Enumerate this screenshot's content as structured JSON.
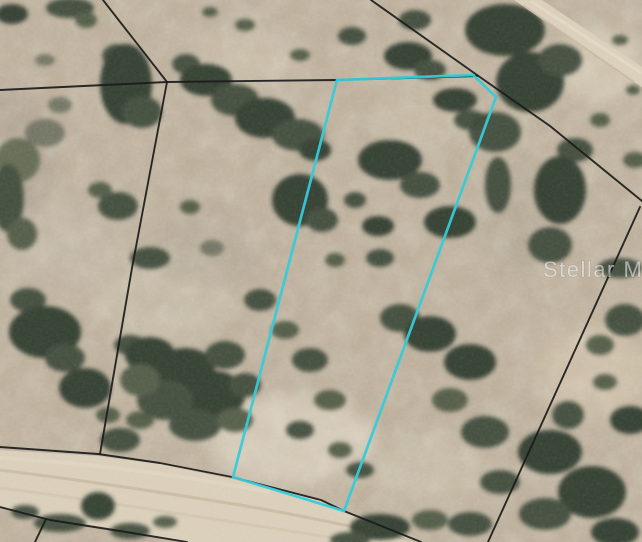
{
  "watermark": {
    "text": "Stellar MLS",
    "color": "#ffffff"
  },
  "colors": {
    "highlight_boundary": "#35cbd9",
    "parcel_line": "#1b1b1b",
    "road_fill": "#d9ceb9",
    "road_track": "#c2b59b",
    "ground": "#b9ac97",
    "tree_dark": "#2c372c"
  },
  "highlighted_parcel": {
    "points": "337,80 473,75 496,97 344,511 233,477"
  },
  "parcel_lines": [
    {
      "points": "103,0 167,82"
    },
    {
      "points": "0,90 167,82"
    },
    {
      "points": "167,82 337,80 477,76"
    },
    {
      "points": "371,0 477,75 550,126 642,201"
    },
    {
      "points": "640,207 488,542"
    },
    {
      "points": "167,82 132,268 100,454"
    },
    {
      "points": "0,447 98,454 160,463 232,477 321,500 344,511 421,542"
    },
    {
      "points": "0,507 50,520 120,531 187,542"
    },
    {
      "points": "46,519 35,542"
    }
  ],
  "roads": [
    {
      "points": "514,0 542,0 642,67 642,87"
    },
    {
      "points": "0,450 98,456 160,464 232,479 321,501 360,517 421,542 187,542 120,531 50,520 0,507"
    }
  ]
}
